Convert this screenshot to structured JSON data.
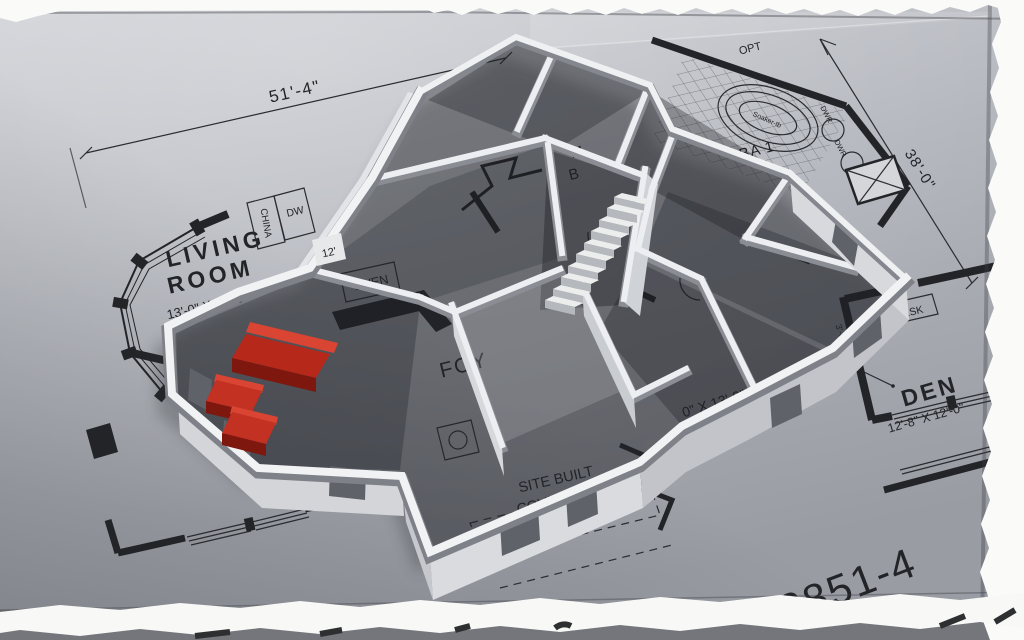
{
  "colors": {
    "paper": "#b4b7be",
    "ink": "#232428",
    "model_white": "#f0f1f3",
    "sofa_red": "#c23122"
  },
  "dimensions": {
    "overall_width": "51'-4\"",
    "overall_depth": "38'-0\""
  },
  "labels": {
    "living_1": "LIVING",
    "living_2": "ROOM",
    "living_size": "13'-0\" X 13'-3\"",
    "den": "DEN",
    "den_size": "12'-8\" X 12'-0\"",
    "foyer": "FOY",
    "master_1": "M",
    "master_2": "B",
    "bath": "BA 1",
    "opt": "OPT",
    "soaker": "Soaker-tb",
    "dwr_1": "DWR",
    "dwr_2": "DWR",
    "china": "CHINA",
    "dw": "DW",
    "oven": "OVEN",
    "desk": "DESK",
    "twelve": "12'",
    "partial_room_size": "0\" X 13'-0\"",
    "entry_1": "SITE BUILT",
    "entry_2": "COVERED",
    "entry_3": "ENTRY",
    "num_36": "36",
    "dim_3_6": "3'-6\"",
    "plan_number": "3851-4",
    "plan_prefix": "A",
    "plan_suffix": "F"
  }
}
